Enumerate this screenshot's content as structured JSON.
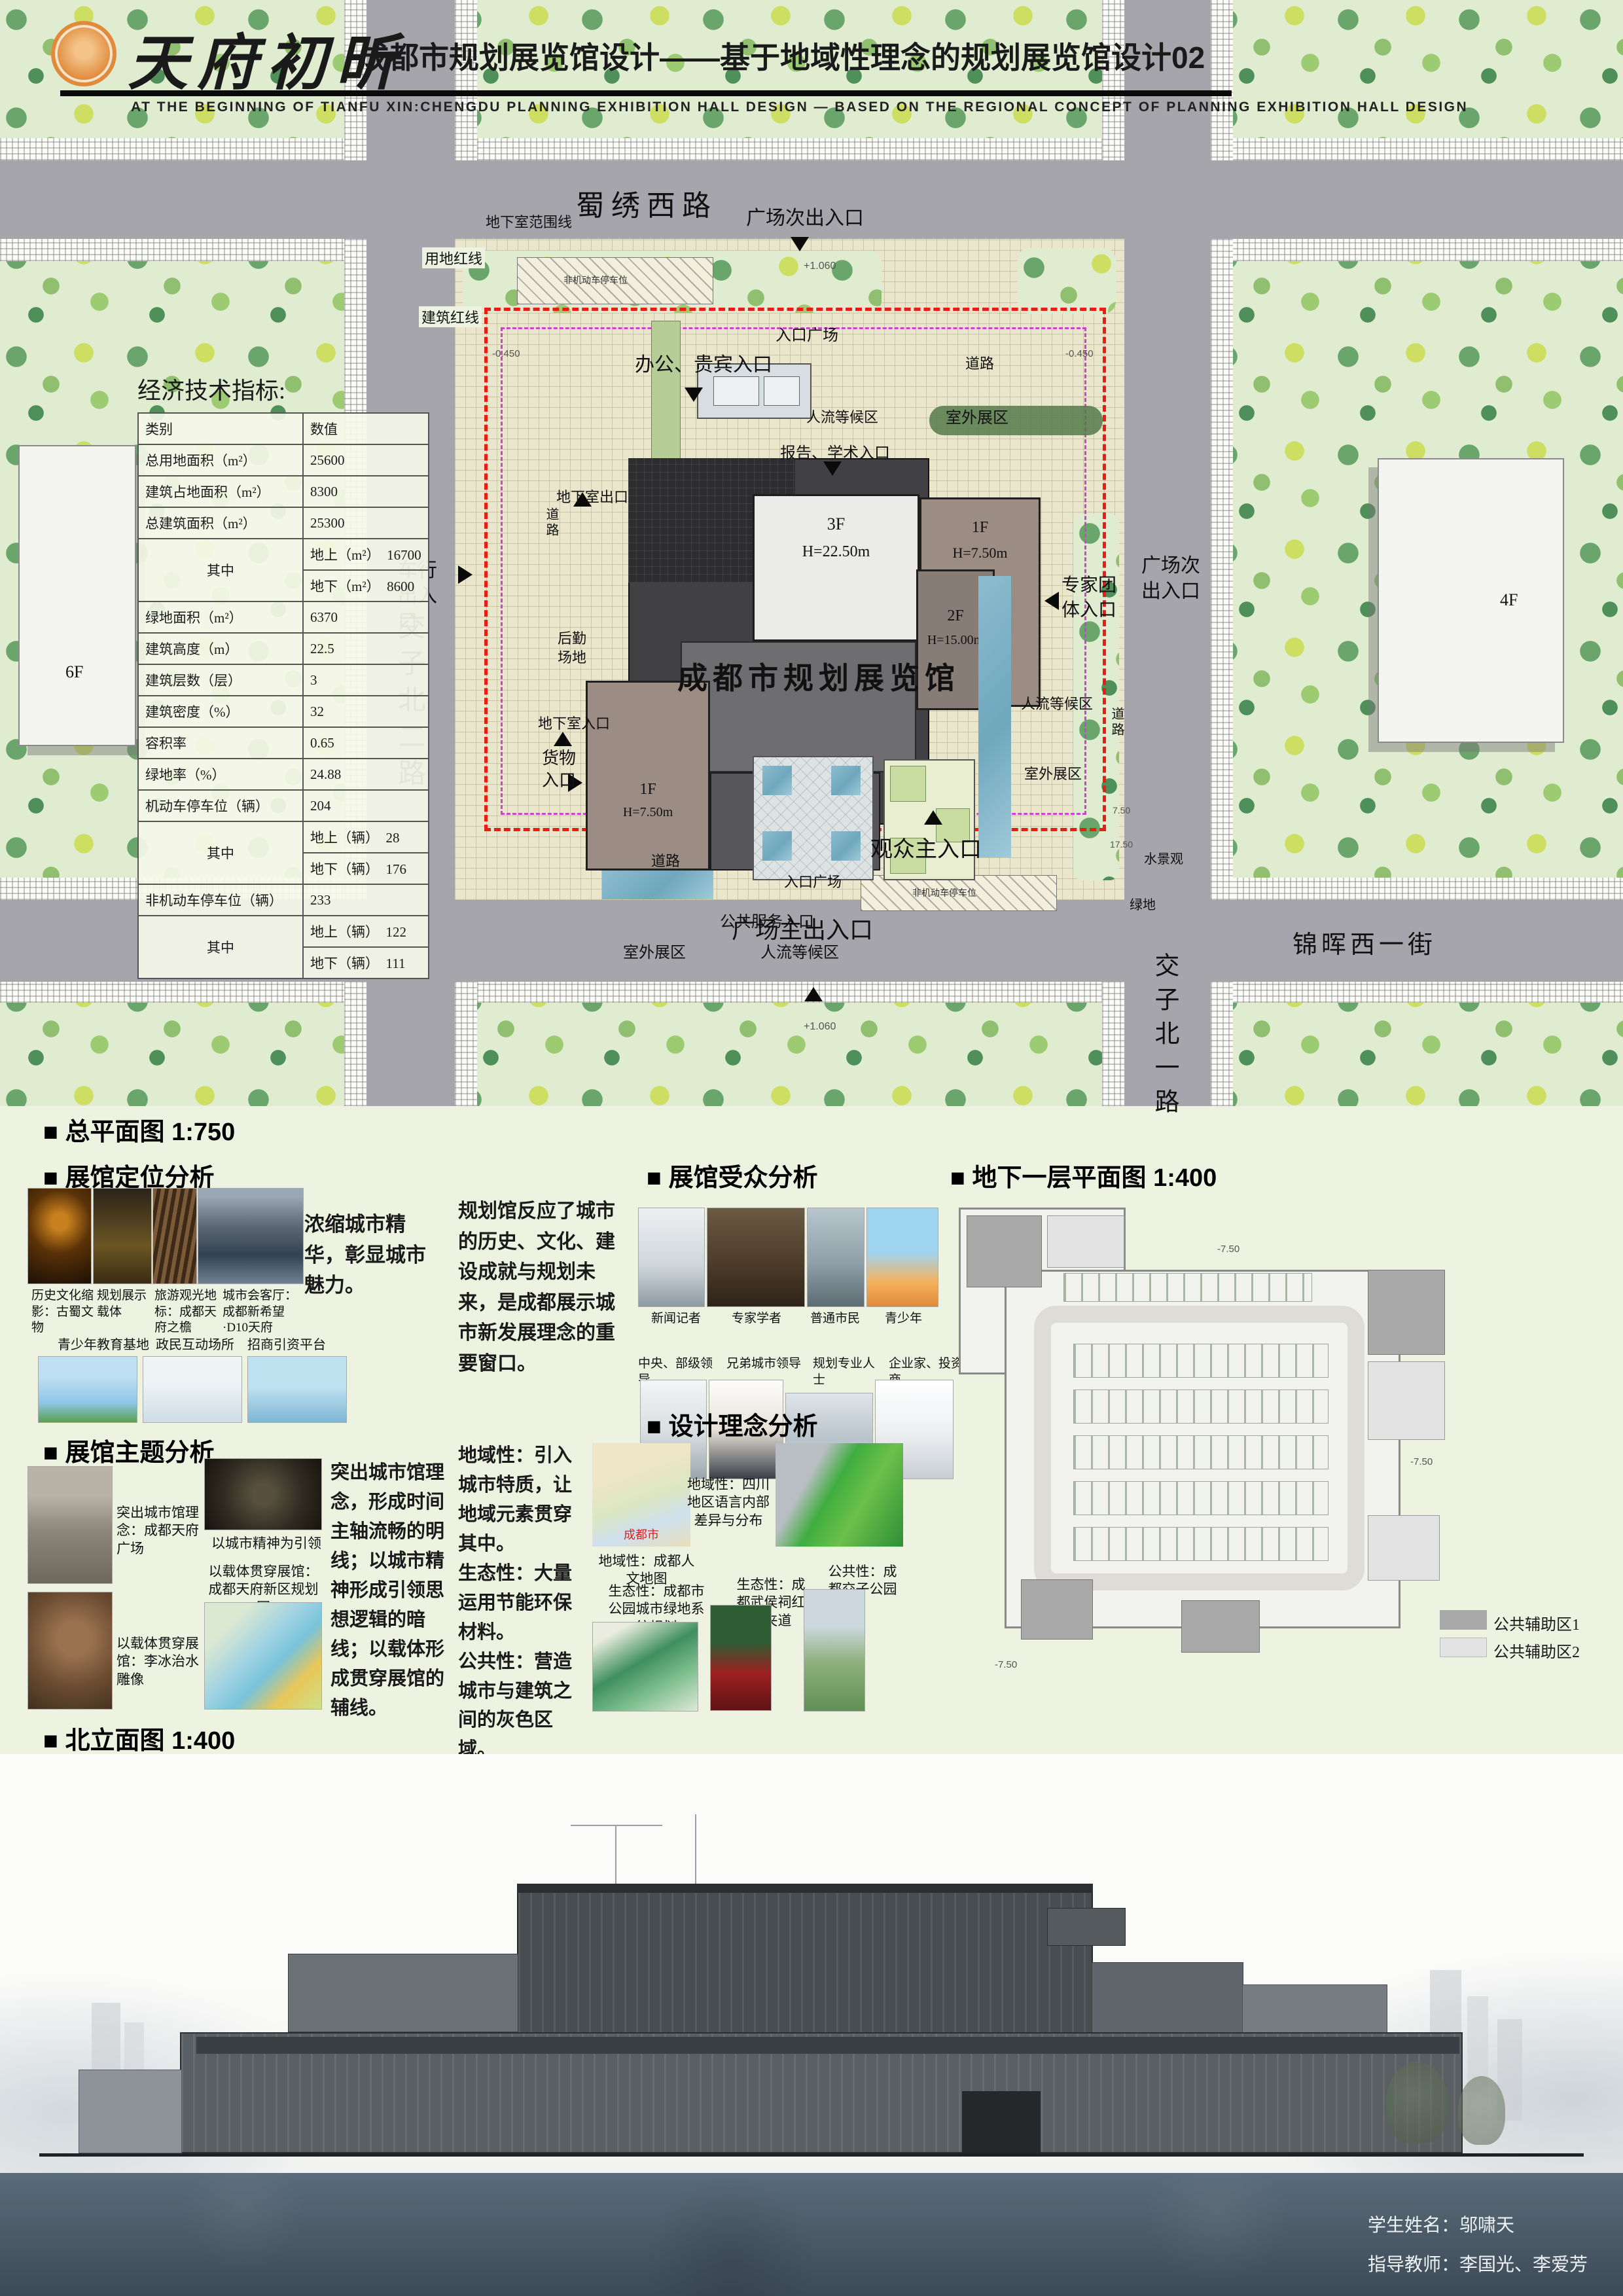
{
  "header": {
    "logo_text": "天府初昕",
    "title": "成都市规划展览馆设计——基于地域性理念的规划展览馆设计02",
    "subtitle": "AT THE BEGINNING OF TIANFU XIN:CHENGDU PLANNING EXHIBITION HALL DESIGN — BASED ON THE REGIONAL CONCEPT OF PLANNING EXHIBITION HALL DESIGN"
  },
  "site_plan": {
    "caption": "■  总平面图  1:750",
    "roads": {
      "north": "蜀绣西路",
      "west": "交子北二路",
      "east": "交子北一路",
      "south": "锦晖西一街"
    },
    "building_label": "成都市规划展览馆",
    "blocks": {
      "b3f_top": {
        "floor": "3F",
        "height": "H=22.50m"
      },
      "b1f_right": {
        "floor": "1F",
        "height": "H=7.50m"
      },
      "b2f": {
        "floor": "2F",
        "height": "H=15.00m"
      },
      "b3f_low": {
        "floor": "3F",
        "height": "H=22.50m"
      },
      "b1f_left": {
        "floor": "1F",
        "height": "H=7.50m"
      }
    },
    "context": {
      "west_building": "6F",
      "east_building": "4F"
    },
    "labels": {
      "plaza_secondary_exit_top": "广场次出入口",
      "plaza_secondary_exit_right": "广场次出入口",
      "vehicle_entrance": "车行出入口",
      "entrance_plaza_top": "入口广场",
      "office_vip_entrance": "办公、贵宾入口",
      "road_top": "道路",
      "outdoor_exhibit_ne": "室外展区",
      "crowd_waiting_top": "人流等候区",
      "report_academic_entrance": "报告、学术入口",
      "basement_exit": "地下室出口",
      "road_left": "道路",
      "expert_group_entrance": "专家团体入口",
      "logistics_yard": "后勤场地",
      "basement_entrance": "地下室入口",
      "cargo_entrance": "货物入口",
      "public_service_entrance": "公共服务入口",
      "outdoor_exhibit_sw": "室外展区",
      "crowd_waiting_bottom": "人流等候区",
      "crowd_waiting_e": "人流等候区",
      "outdoor_exhibit_e": "室外展区",
      "road_e": "道路",
      "visitor_main_entrance": "观众主入口",
      "road_bottom": "道路",
      "entrance_plaza_bottom": "入口广场",
      "plaza_main_exit": "广场主出入口",
      "water_feature": "水景观",
      "green_space": "绿地",
      "basement_range_line": "地下室范围线",
      "land_red_line": "用地红线",
      "building_red_line": "建筑红线",
      "bike_parking": "非机动车停车位",
      "level_top": "+1.060",
      "level_bottom": "+1.060",
      "level_left": "-0.450",
      "level_right": "-0.450",
      "dim_a": "7.50",
      "dim_b": "17.50"
    }
  },
  "indicators": {
    "title": "经济技术指标:",
    "col_category": "类别",
    "col_value": "数值",
    "zhong": "其中",
    "rows": {
      "r1": {
        "label": "总用地面积（m²）",
        "value": "25600"
      },
      "r2": {
        "label": "建筑占地面积（m²）",
        "value": "8300"
      },
      "r3": {
        "label": "总建筑面积（m²）",
        "value": "25300"
      },
      "r4a": {
        "label": "地上（m²）",
        "value": "16700"
      },
      "r4b": {
        "label": "地下（m²）",
        "value": "8600"
      },
      "r5": {
        "label": "绿地面积（m²）",
        "value": "6370"
      },
      "r6": {
        "label": "建筑高度（m）",
        "value": "22.5"
      },
      "r7": {
        "label": "建筑层数（层）",
        "value": "3"
      },
      "r8": {
        "label": "建筑密度（%）",
        "value": "32"
      },
      "r9": {
        "label": "容积率",
        "value": "0.65"
      },
      "r10": {
        "label": "绿地率（%）",
        "value": "24.88"
      },
      "r11": {
        "label": "机动车停车位（辆）",
        "value": "204"
      },
      "r11a": {
        "label": "地上（辆）",
        "value": "28"
      },
      "r11b": {
        "label": "地下（辆）",
        "value": "176"
      },
      "r12": {
        "label": "非机动车停车位（辆）",
        "value": "233"
      },
      "r12a": {
        "label": "地上（辆）",
        "value": "122"
      },
      "r12b": {
        "label": "地下（辆）",
        "value": "111"
      }
    }
  },
  "sections": {
    "positioning": {
      "title": "■  展馆定位分析",
      "statement": "浓缩城市精华，彰显城市魅力。",
      "captions1": [
        "历史文化缩影：古蜀文物",
        "规划展示载体",
        "旅游观光地标：成都天府之檐",
        "城市会客厅：成都新希望·D10天府"
      ],
      "captions2": [
        "青少年教育基地",
        "政民互动场所",
        "招商引资平台"
      ]
    },
    "audience": {
      "title": "■  展馆受众分析",
      "statement": "规划馆反应了城市的历史、文化、建设成就与规划未来，是成都展示城市新发展理念的重要窗口。",
      "captions1": [
        "新闻记者",
        "专家学者",
        "普通市民",
        "青少年"
      ],
      "captions2": [
        "中央、部级领导",
        "兄弟城市领导",
        "规划专业人士",
        "企业家、投资商"
      ]
    },
    "theme": {
      "title": "■  展馆主题分析",
      "statement": "突出城市馆理念，形成时间主轴流畅的明线；以城市精神形成引领思想逻辑的暗线；以载体形成贯穿展馆的辅线。",
      "captions": [
        "突出城市馆理念：成都天府广场",
        "以城市精神为引领",
        "以载体贯穿展馆：李冰治水雕像",
        "以载体贯穿展馆：成都天府新区规划图"
      ]
    },
    "concept": {
      "title": "■  设计理念分析",
      "statement": "地域性：引入城市特质，让地域元素贯穿其中。\n生态性：大量运用节能环保材料。\n公共性：营造城市与建筑之间的灰色区域。",
      "captions": [
        "地域性：成都人文地图",
        "地域性：四川地区语言内部差异与分布",
        "生态性：成都市公园城市绿地系统规划",
        "生态性：成都武侯祠红墙夹道",
        "公共性：成都交子公园"
      ],
      "map_label": "成都市"
    },
    "basement": {
      "title": "■  地下一层平面图  1:400",
      "legend": [
        {
          "label": "公共辅助区1",
          "color": "#a9a9a9"
        },
        {
          "label": "公共辅助区2",
          "color": "#e3e3e3"
        }
      ],
      "level_mark": "-7.50"
    },
    "elevation": {
      "title": "■  北立面图  1:400"
    }
  },
  "footer": {
    "student": "学生姓名：邬啸天",
    "advisors": "指导教师：李国光、李爱芳"
  },
  "colors": {
    "land_red_line": "#e61e14",
    "building_line": "#cc44cc",
    "road_gray": "#a5a5ab",
    "logo_orange": "#e08a3c"
  }
}
